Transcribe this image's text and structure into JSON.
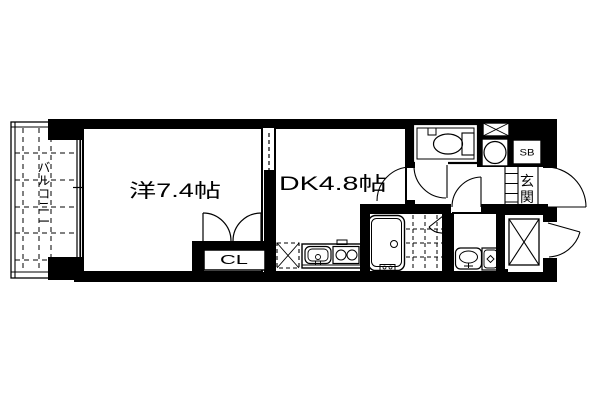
{
  "page": {
    "background_color": "#ffffff",
    "line_color": "#000000",
    "type": "apartment floor plan"
  },
  "floor_plan": {
    "balcony": {
      "label": "バルコニー",
      "chars": [
        "バ",
        "ル",
        "コ",
        "ニ",
        "ー"
      ]
    },
    "western_room": {
      "label": "洋7.4帖"
    },
    "dining_kitchen": {
      "label": "DK4.8帖"
    },
    "closet": {
      "label": "CL"
    },
    "shoe_box": {
      "label": "SB"
    },
    "entrance": {
      "label": "玄関",
      "chars": [
        "玄",
        "関"
      ]
    },
    "fixtures": [
      "toilet",
      "bathtub",
      "bathroom-tile-floor",
      "washbasin",
      "washing-machine",
      "kitchen-sink",
      "gas-stove",
      "refrigerator-space",
      "water-heater",
      "meter-box",
      "pipe-shaft",
      "balcony-window",
      "sliding-door",
      "entrance-door",
      "service-door",
      "closet-double-doors"
    ]
  }
}
